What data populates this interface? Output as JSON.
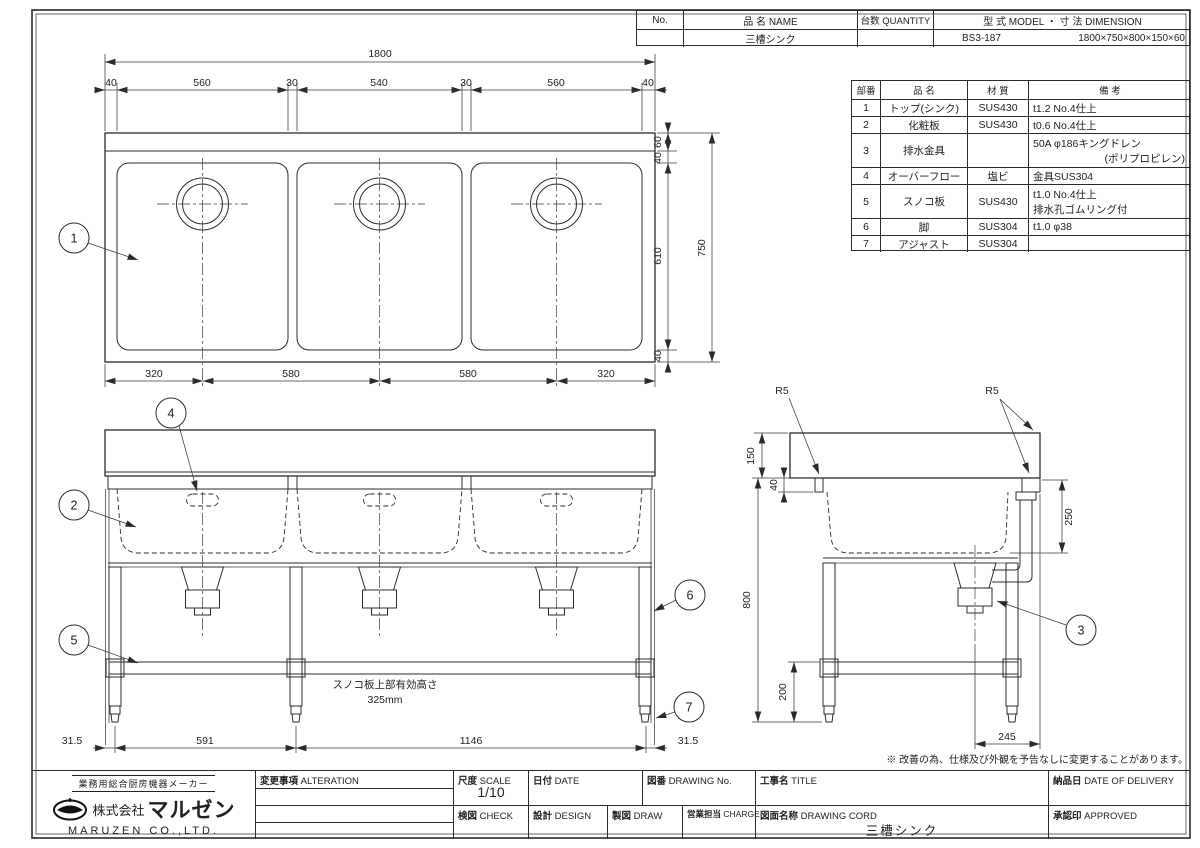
{
  "header_table": {
    "no_label": "No.",
    "name_label": "品 名 NAME",
    "qty_label": "台数 QUANTITY",
    "model_dim_label": "型 式 MODEL ・ 寸 法 DIMENSION",
    "value_name": "三槽シンク",
    "value_qty": "",
    "value_model": "BS3-187",
    "value_dimension": "1800×750×800×150×60"
  },
  "parts_table": {
    "h_no": "部番",
    "h_name": "品 名",
    "h_material": "材 質",
    "h_remarks": "備 考",
    "rows": [
      {
        "no": "1",
        "name": "トップ(シンク)",
        "material": "SUS430",
        "remarks": "t1.2 No.4仕上",
        "remarks2": ""
      },
      {
        "no": "2",
        "name": "化粧板",
        "material": "SUS430",
        "remarks": "t0.6 No.4仕上",
        "remarks2": ""
      },
      {
        "no": "3",
        "name": "排水金具",
        "material": "",
        "remarks": "50A φ186キングドレン",
        "remarks2": "(ポリプロピレン)"
      },
      {
        "no": "4",
        "name": "オーバーフロー",
        "material": "塩ビ",
        "remarks": "金具SUS304",
        "remarks2": ""
      },
      {
        "no": "5",
        "name": "スノコ板",
        "material": "SUS430",
        "remarks": "t1.0 No.4仕上",
        "remarks2": "排水孔ゴムリング付"
      },
      {
        "no": "6",
        "name": "脚",
        "material": "SUS304",
        "remarks": "t1.0 φ38",
        "remarks2": ""
      },
      {
        "no": "7",
        "name": "アジャスト",
        "material": "SUS304",
        "remarks": "",
        "remarks2": ""
      }
    ]
  },
  "drawing": {
    "plan": {
      "balloon1": "1",
      "total_w": "1800",
      "top_segs": [
        "40",
        "560",
        "30",
        "540",
        "30",
        "560",
        "40"
      ],
      "right_segs": [
        "60",
        "40",
        "610",
        "40"
      ],
      "total_d": "750",
      "bottom_segs": [
        "320",
        "580",
        "580",
        "320"
      ]
    },
    "front": {
      "balloon2": "2",
      "balloon4": "4",
      "balloon5": "5",
      "balloon6": "6",
      "balloon7": "7",
      "bottom_segs": [
        "31.5",
        "591",
        "1146",
        "31.5"
      ],
      "note1": "スノコ板上部有効高さ",
      "note2": "325mm"
    },
    "side": {
      "balloon3": "3",
      "r5_left": "R5",
      "r5_right": "R5",
      "d_backsplash": "150",
      "d_edge": "40",
      "d_depth": "250",
      "d_height": "800",
      "d_shelf": "200",
      "d_bottom": "245"
    }
  },
  "note": "※ 改善の為、仕様及び外観を予告なしに変更することがあります。",
  "title_block": {
    "tagline": "業務用総合厨房機器メーカー",
    "company_prefix": "株式会社",
    "company_name": "マルゼン",
    "company_en": "MARUZEN CO.,LTD.",
    "alteration_jp": "変更事項",
    "alteration_en": "ALTERATION",
    "scale_jp": "尺度",
    "scale_en": "SCALE",
    "scale_value": "1/10",
    "date_jp": "日付",
    "date_en": "DATE",
    "dwgno_jp": "図番",
    "dwgno_en": "DRAWING No.",
    "title_jp": "工事名",
    "title_en": "TITLE",
    "delivery_jp": "納品日",
    "delivery_en": "DATE OF DELIVERY",
    "check_jp": "検図",
    "check_en": "CHECK",
    "design_jp": "設計",
    "design_en": "DESIGN",
    "draw_jp": "製図",
    "draw_en": "DRAW",
    "charge_jp": "営業担当",
    "charge_en": "CHARGE",
    "dwgname_jp": "図面名称",
    "dwgname_en": "DRAWING CORD",
    "dwgname_value": "三槽シンク",
    "approved_jp": "承認印",
    "approved_en": "APPROVED"
  }
}
